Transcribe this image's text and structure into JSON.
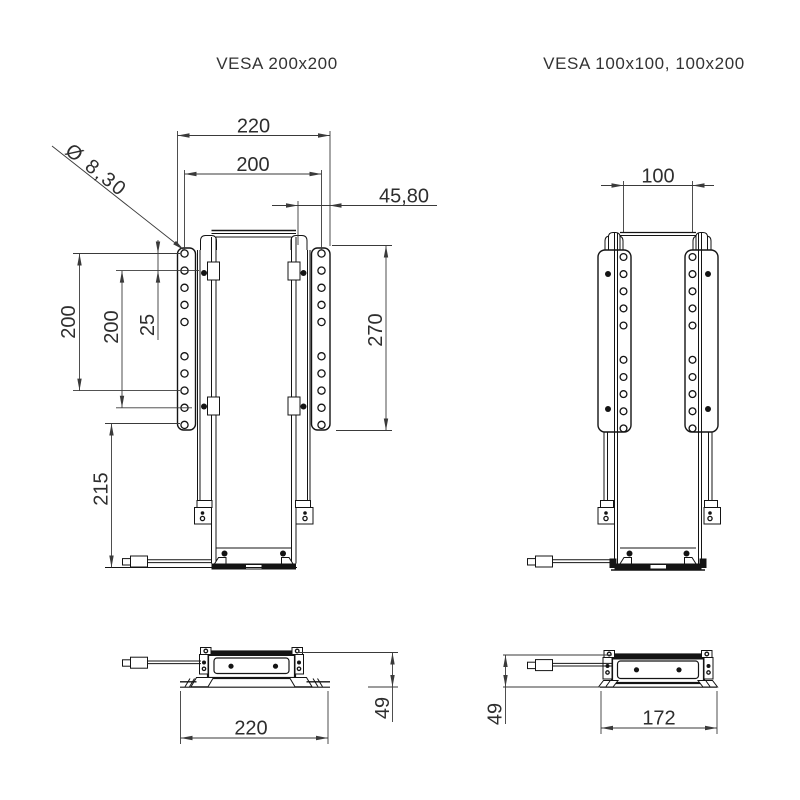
{
  "document": {
    "type": "technical-drawing",
    "background": "#ffffff",
    "line_color": "#141414",
    "dimension_color": "#3a3a3a",
    "text_color": "#2e2e2e"
  },
  "views": {
    "front_left": {
      "title": "VESA 200x200",
      "dims": {
        "overall_width": "220",
        "vesa_width": "200",
        "depth_offset": "45,80",
        "hole_dia": "Ø 8,30",
        "vesa_height_outer": "200",
        "vesa_height_inner": "200",
        "hole_pitch": "25",
        "bracket_length": "270",
        "lower_section": "215"
      }
    },
    "front_right": {
      "title": "VESA 100x100, 100x200",
      "dims": {
        "vesa_width": "100"
      }
    },
    "side_left": {
      "dims": {
        "overall_width": "220",
        "depth": "49"
      }
    },
    "side_right": {
      "dims": {
        "overall_width": "172",
        "depth": "49"
      }
    }
  }
}
